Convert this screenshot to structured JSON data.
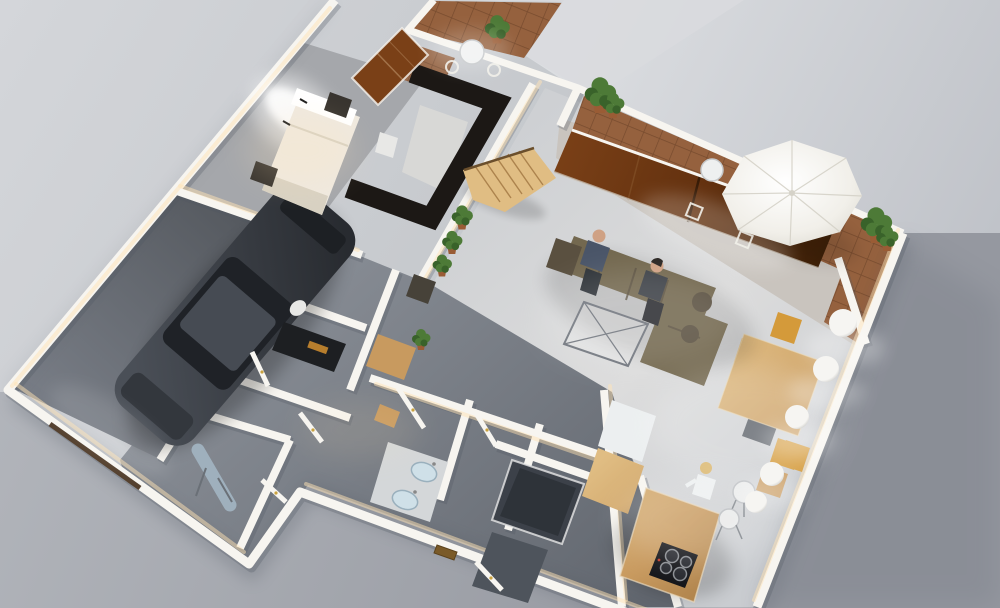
{
  "meta": {
    "type": "3d-floorplan-render",
    "view": "rotated-top-down-dollhouse"
  },
  "colors": {
    "bg_top": "#d4d6da",
    "bg_mid": "#c6c9cd",
    "bg_bottom": "#a6a9af",
    "bg_light": "#e0e2e5",
    "bg_light2": "#bfc2c8",
    "bg_dark": "#b2b5bb",
    "bg_dark2": "#9598a0",
    "wall": "#f7f5f0",
    "wall_shadow": "#4e5560",
    "glow": "#ffe3b5",
    "floor_living_a": "#c9ccd0",
    "floor_living_b": "#dcdcdc",
    "floor_hall_a": "#8a8f97",
    "floor_hall_b": "#62676f",
    "floor_garage_a": "#55595f",
    "floor_garage_b": "#7b8089",
    "floor_bedroom": "#a5a7ab",
    "terrace": "#d9dbde",
    "concrete": "#c9c4be",
    "tile": "#95613e",
    "tile_dark": "#774b2e",
    "dark_wall": "#1c1815",
    "closet_floor": "#d8d8d6",
    "wood": "#c89a5f",
    "wood_dark": "#a07540",
    "wood_light": "#e0bd83",
    "door_glass": "#7a4017",
    "door_glass_mid": "#63310f",
    "door_glass_dark": "#3b1f07",
    "sofa": "#73684f",
    "sofa_dark": "#5a5040",
    "car_a": "#4a4f57",
    "car_b": "#282b30",
    "car_glass": "#1f2227",
    "bed": "#efe9df",
    "bed_dark": "#d8d1c2",
    "nightstand": "#38342f",
    "umbrella": "#f1efe9",
    "umbrella_dark": "#d5d2c8",
    "pendant": "#f6f5f2",
    "pendant_dark": "#aeaeab",
    "plant": "#4d7a37",
    "plant_dark": "#39622a",
    "pot": "#9a5c35",
    "steel": "#9fb0bd",
    "cooktop": "#141519",
    "amber": "#c9882f",
    "gold": "#c9a23f",
    "mailslot": "#7a5a28",
    "vanity": "#d4d7d9",
    "sink": "#cfe0e8",
    "shower": "#3c4149",
    "mat": "#4e545c",
    "skin": "#cfa184",
    "hair_blonde": "#d9b469",
    "hair_dark": "#2b2623",
    "shirt_man": "#4a5568",
    "person_dark": "#3c4046",
    "white_obj": "#e8e8e6",
    "chair_orange": "#d49a3a",
    "bench_gray": "#5f646b"
  },
  "scene": {
    "rooms": [
      {
        "name": "garage"
      },
      {
        "name": "bedroom"
      },
      {
        "name": "closet"
      },
      {
        "name": "balcony"
      },
      {
        "name": "hallway"
      },
      {
        "name": "laundry-room"
      },
      {
        "name": "ironing-room"
      },
      {
        "name": "bathroom"
      },
      {
        "name": "living-room"
      },
      {
        "name": "dining-area"
      },
      {
        "name": "kitchen"
      },
      {
        "name": "patio"
      }
    ],
    "people": [
      {
        "name": "man-on-sofa"
      },
      {
        "name": "woman-on-sofa"
      },
      {
        "name": "woman-at-kitchen-island"
      }
    ],
    "furniture": [
      "car",
      "double-bed",
      "nightstands",
      "wall-sconces",
      "wardrobe",
      "winder-staircase",
      "corner-sofa",
      "glass-coffee-table",
      "sliding-glass-door",
      "patio-umbrella",
      "patio-table",
      "patio-chairs",
      "balcony-table",
      "balcony-chairs",
      "planter-plants",
      "potted-plants",
      "dining-table",
      "dining-chairs",
      "bench",
      "pendant-lamps",
      "kitchen-island",
      "cooktop",
      "bar-stools",
      "bar-chairs",
      "counters",
      "wood-stove",
      "toilet",
      "dresser",
      "ironing-board",
      "double-sink-vanity",
      "shower",
      "entry-mat",
      "mail-slot"
    ],
    "counts": {
      "pendant_lamps": 5,
      "hall_potted_plants": 3,
      "sofa_people": 2
    }
  }
}
